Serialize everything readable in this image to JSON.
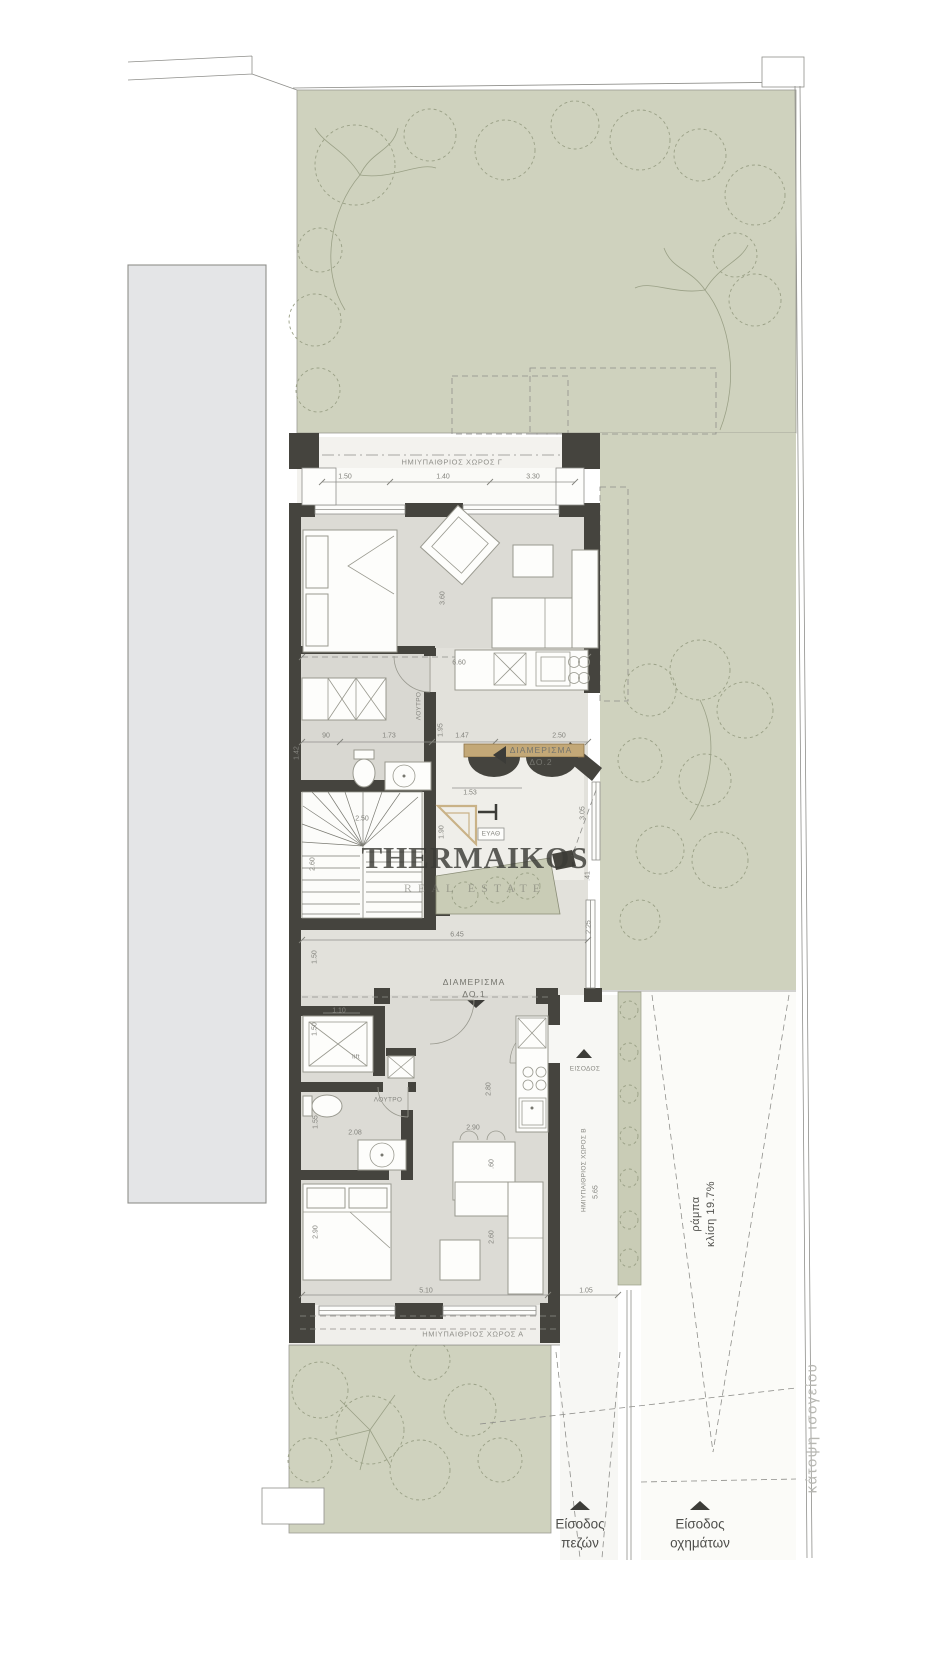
{
  "watermark": {
    "title": "THERMAIKOS",
    "tagline": "REAL ESTATE"
  },
  "colors": {
    "garden": "#cfd2be",
    "hedge": "#c9ccb6",
    "wall": "#45443e",
    "floor": "#dcdbd5",
    "balcony": "#f0efeb",
    "neighbor": "#e4e5e7",
    "logo_gold": "#c3a877",
    "watermark_gray": "#4a4a48"
  },
  "annotations": [
    {
      "id": "label-semi-open-c",
      "text": "ΗΜΙΥΠΑΙΘΡΙΟΣ ΧΩΡΟΣ Γ",
      "x": 452,
      "y": 462,
      "cls": "room"
    },
    {
      "id": "label-apartment-do2-line1",
      "text": "ΔΙΑΜΕΡΙΣΜΑ",
      "x": 541,
      "y": 750,
      "cls": "apt"
    },
    {
      "id": "label-apartment-do2-line2",
      "text": "ΔΟ.2",
      "x": 541,
      "y": 762,
      "cls": "apt"
    },
    {
      "id": "label-bath-upper",
      "text": "ΛΟΥΤΡΟ",
      "x": 419,
      "y": 706,
      "rot": -90,
      "cls": "tinylab"
    },
    {
      "id": "label-water-meter",
      "text": "ΕΥΑΘ",
      "x": 491,
      "y": 834,
      "cls": "tinylab"
    },
    {
      "id": "label-lift",
      "text": "lift",
      "x": 356,
      "y": 1057,
      "cls": "tinylab"
    },
    {
      "id": "label-bath-lower",
      "text": "ΛΟΥΤΡΟ",
      "x": 388,
      "y": 1100,
      "cls": "tinylab"
    },
    {
      "id": "label-apartment-do1-line1",
      "text": "ΔΙΑΜΕΡΙΣΜΑ",
      "x": 474,
      "y": 982,
      "cls": "apt"
    },
    {
      "id": "label-apartment-do1-line2",
      "text": "ΔΟ.1",
      "x": 474,
      "y": 994,
      "cls": "apt"
    },
    {
      "id": "label-entrance",
      "text": "ΕΙΣΟΔΟΣ",
      "x": 585,
      "y": 1069,
      "cls": "tinylab"
    },
    {
      "id": "label-semi-open-b",
      "text": "ΗΜΙΥΠΑΙΘΡΙΟΣ ΧΩΡΟΣ Β",
      "x": 584,
      "y": 1170,
      "rot": -90,
      "cls": "tinylab"
    },
    {
      "id": "label-semi-open-a",
      "text": "ΗΜΙΥΠΑΙΘΡΙΟΣ ΧΩΡΟΣ Α",
      "x": 473,
      "y": 1334,
      "cls": "room"
    },
    {
      "id": "label-ramp-line1",
      "text": "ράμπα",
      "x": 696,
      "y": 1214,
      "rot": -90,
      "cls": "ramp"
    },
    {
      "id": "label-ramp-line2",
      "text": "κλίση 19.7%",
      "x": 711,
      "y": 1214,
      "rot": -90,
      "cls": "ramp"
    },
    {
      "id": "label-entry-pedestrian-line1",
      "text": "Είσοδος",
      "x": 580,
      "y": 1524,
      "cls": "entry"
    },
    {
      "id": "label-entry-pedestrian-line2",
      "text": "πεζών",
      "x": 580,
      "y": 1543,
      "cls": "entry"
    },
    {
      "id": "label-entry-vehicles-line1",
      "text": "Είσοδος",
      "x": 700,
      "y": 1524,
      "cls": "entry"
    },
    {
      "id": "label-entry-vehicles-line2",
      "text": "οχημάτων",
      "x": 700,
      "y": 1543,
      "cls": "entry"
    },
    {
      "id": "label-plan-caption",
      "text": "κάτοψη ισογείου",
      "x": 812,
      "y": 1428,
      "rot": -90,
      "cls": "caption"
    }
  ],
  "dimensions": [
    {
      "text": "1.50",
      "x": 345,
      "y": 477
    },
    {
      "text": "1.40",
      "x": 443,
      "y": 477
    },
    {
      "text": "3.30",
      "x": 533,
      "y": 477
    },
    {
      "text": "3.60",
      "x": 443,
      "y": 598,
      "rot": -90
    },
    {
      "text": "6.60",
      "x": 459,
      "y": 663
    },
    {
      "text": "90",
      "x": 326,
      "y": 736
    },
    {
      "text": "1.73",
      "x": 389,
      "y": 736
    },
    {
      "text": "1.47",
      "x": 462,
      "y": 736
    },
    {
      "text": "2.50",
      "x": 559,
      "y": 736
    },
    {
      "text": "1.42",
      "x": 297,
      "y": 753,
      "rot": -90
    },
    {
      "text": "1.95",
      "x": 441,
      "y": 730,
      "rot": -90
    },
    {
      "text": "1.53",
      "x": 470,
      "y": 793
    },
    {
      "text": "1.90",
      "x": 442,
      "y": 832,
      "rot": -90
    },
    {
      "text": "3.05",
      "x": 583,
      "y": 813,
      "rot": -90
    },
    {
      "text": ".41",
      "x": 588,
      "y": 876,
      "rot": -90
    },
    {
      "text": "2.50",
      "x": 362,
      "y": 819
    },
    {
      "text": "2.60",
      "x": 313,
      "y": 864,
      "rot": -90
    },
    {
      "text": "6.45",
      "x": 457,
      "y": 935
    },
    {
      "text": "2.25",
      "x": 589,
      "y": 927,
      "rot": -90
    },
    {
      "text": "1.50",
      "x": 315,
      "y": 957,
      "rot": -90
    },
    {
      "text": "1.10",
      "x": 339,
      "y": 1011
    },
    {
      "text": "1.50",
      "x": 315,
      "y": 1029,
      "rot": -90
    },
    {
      "text": "2.08",
      "x": 355,
      "y": 1133
    },
    {
      "text": "1.55",
      "x": 316,
      "y": 1122,
      "rot": -90
    },
    {
      "text": "2.90",
      "x": 473,
      "y": 1128
    },
    {
      "text": "2.80",
      "x": 489,
      "y": 1089,
      "rot": -90
    },
    {
      "text": ".60",
      "x": 492,
      "y": 1164,
      "rot": -90
    },
    {
      "text": "2.90",
      "x": 316,
      "y": 1232,
      "rot": -90
    },
    {
      "text": "2.60",
      "x": 492,
      "y": 1237,
      "rot": -90
    },
    {
      "text": "5.10",
      "x": 426,
      "y": 1291
    },
    {
      "text": "1.05",
      "x": 586,
      "y": 1291
    },
    {
      "text": "5.65",
      "x": 596,
      "y": 1192,
      "rot": -90
    }
  ]
}
